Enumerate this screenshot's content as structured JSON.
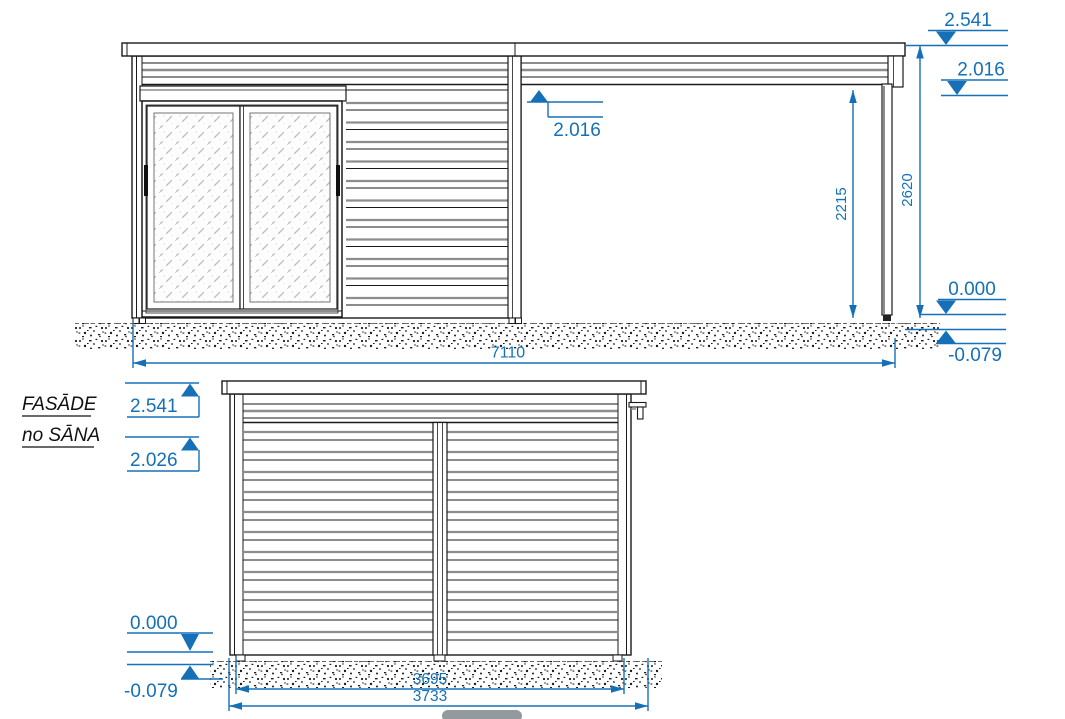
{
  "drawing_title": {
    "line1": "FASĀDE",
    "line2": "no SĀNA"
  },
  "colors": {
    "dimension_blue": "#1570b8",
    "line_black": "#1a1a1a",
    "line_gray": "#8d8d8d"
  },
  "front_elevation": {
    "levels": {
      "roof_top": "2.541",
      "canopy_beam_bottom": "2.016",
      "canopy_clearance": "2.016",
      "floor_zero": "0.000",
      "ground": "-0.079"
    },
    "dimensions": {
      "total_width": "7110",
      "post_clear_height": "2215",
      "overall_height": "2620"
    }
  },
  "side_elevation": {
    "levels": {
      "roof_top": "2.541",
      "wall_top": "2.026",
      "floor_zero": "0.000",
      "ground": "-0.079"
    },
    "dimensions": {
      "wall_width": "3695",
      "overall_width": "3733"
    }
  }
}
